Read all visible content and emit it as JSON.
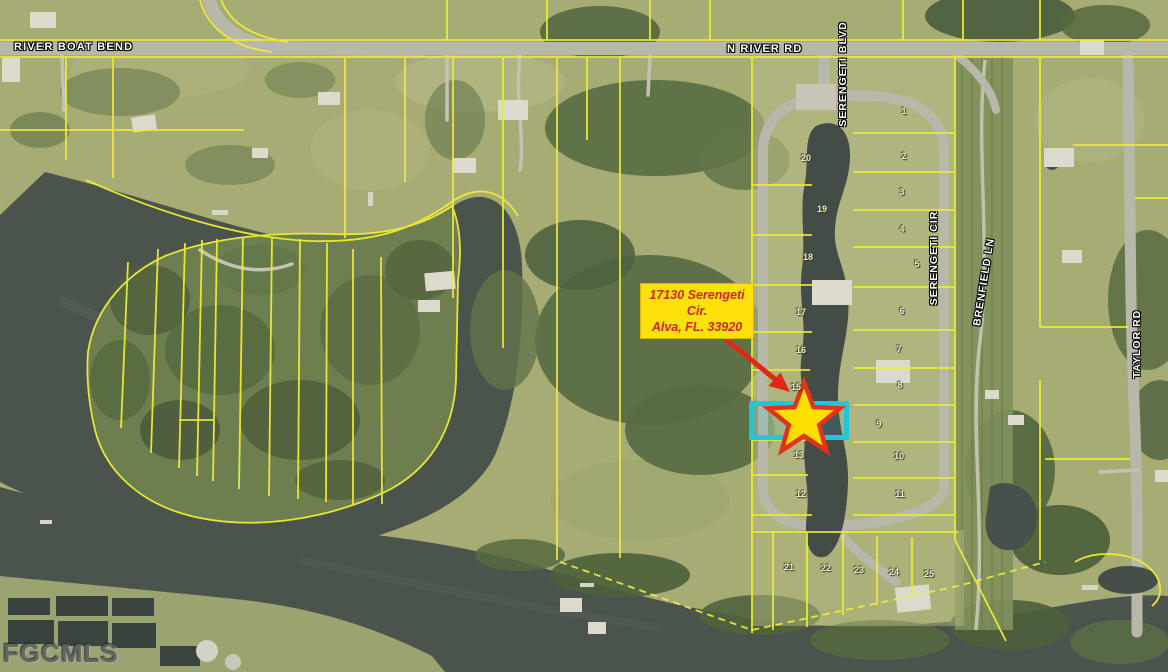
{
  "watermark": "FGCMLS",
  "annotation": {
    "line1": "17130 Serengeti Cir.",
    "line2": "Alva, FL. 33920"
  },
  "road_labels": {
    "river_boat_bend": "RIVER BOAT BEND",
    "n_river_rd": "N RIVER RD",
    "serengeti_blvd": "SERENGETI BLVD",
    "serengeti_cir": "SERENGETI CIR",
    "brenfield_ln": "BRENFIELD LN",
    "taylor_rd": "TAYLOR RD"
  },
  "lots": [
    "1",
    "2",
    "3",
    "4",
    "5",
    "6",
    "7",
    "8",
    "9",
    "10",
    "11",
    "12",
    "13",
    "15",
    "16",
    "17",
    "18",
    "19",
    "20",
    "21",
    "22",
    "23",
    "24",
    "25"
  ],
  "colors": {
    "field": "#a7ac75",
    "water": "#4b534d",
    "parcel_line": "#eeeb38",
    "road": "#b8b8aa",
    "highlight_box": "#1fc7d9",
    "star_fill": "#ffdf00",
    "star_outline": "#e23318",
    "arrow": "#e02818",
    "annotation_bg": "#ffe10a",
    "annotation_text": "#d42420"
  }
}
